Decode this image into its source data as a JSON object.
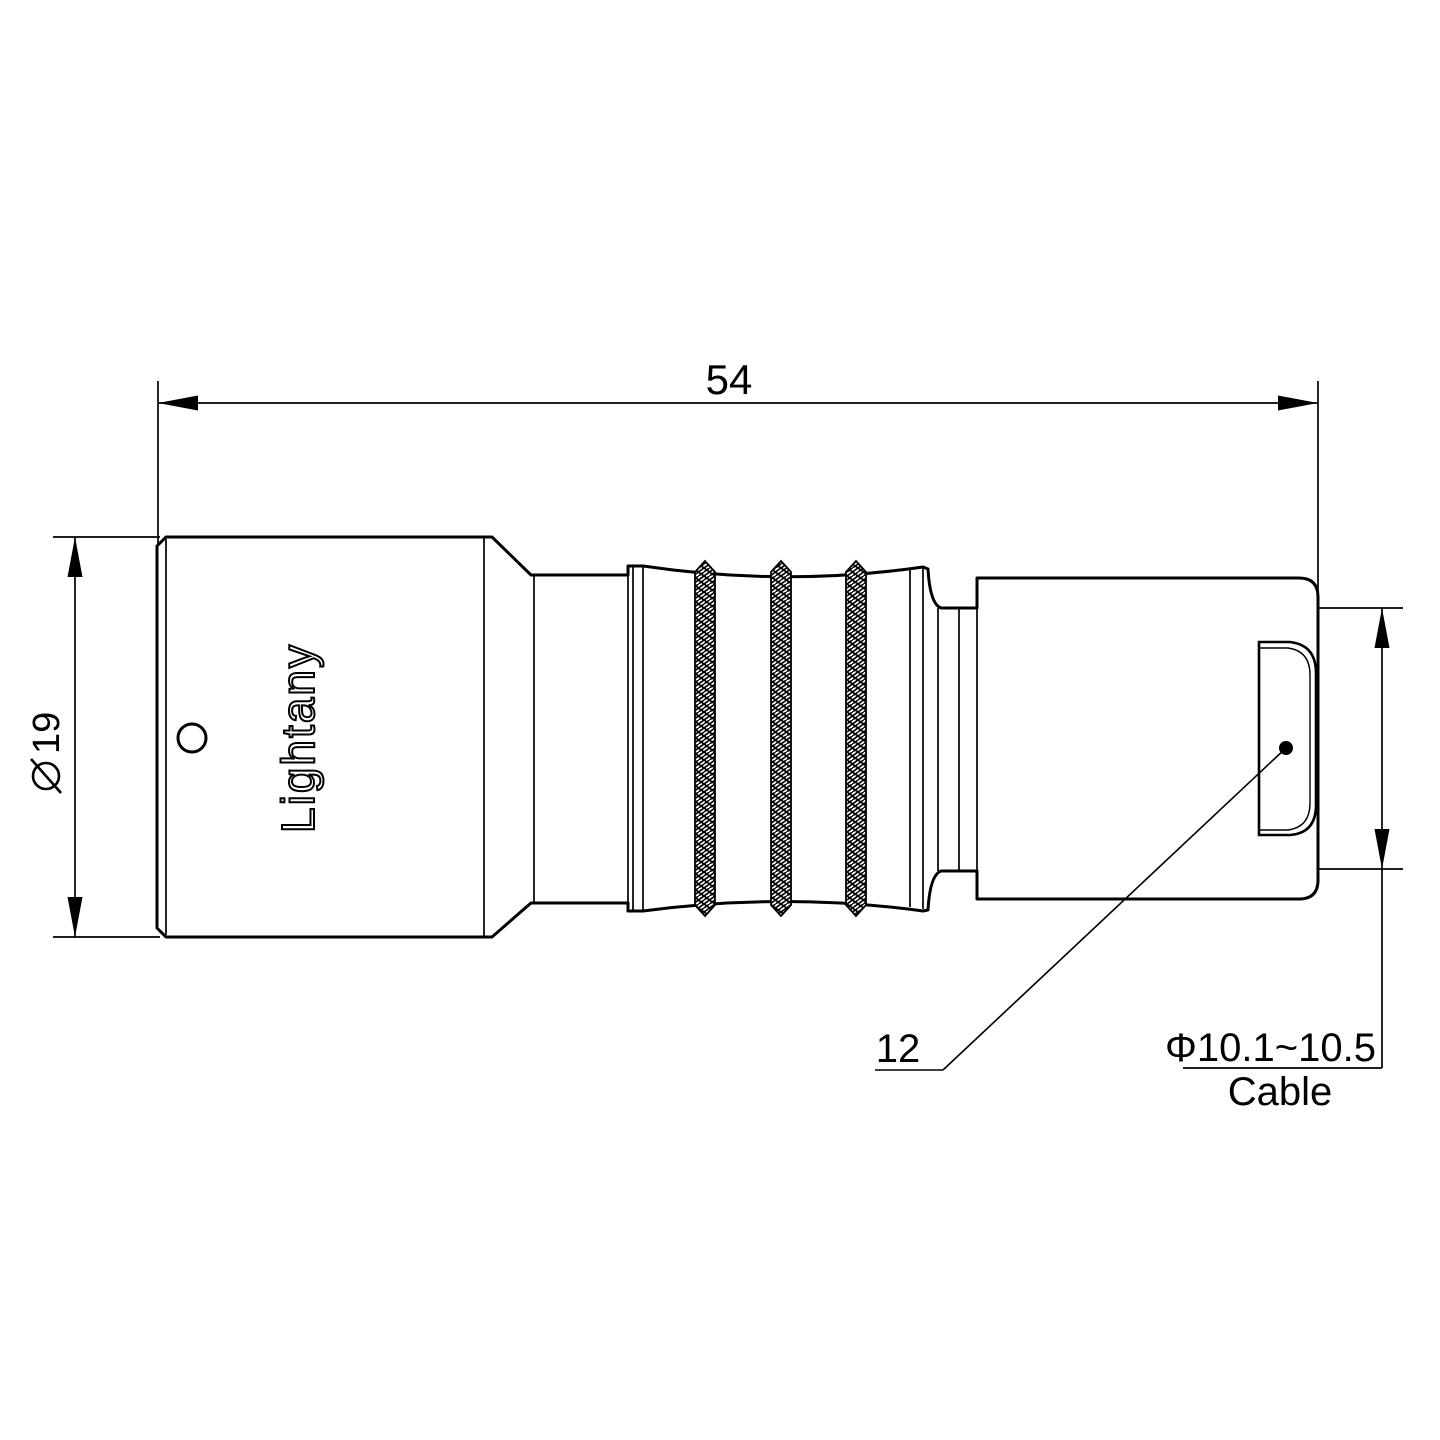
{
  "drawing": {
    "type": "connector-technical-drawing",
    "colors": {
      "line": "#000000",
      "background": "#ffffff",
      "watermark": "#f2c0c3"
    },
    "dimensions": {
      "overall_length": "54",
      "front_diameter": "19",
      "boot_width": "12",
      "cable_range": "Φ10.1~10.5",
      "cable_label": "Cable"
    },
    "branding": {
      "engraving": "Lightany",
      "watermark": "Lightany"
    }
  }
}
